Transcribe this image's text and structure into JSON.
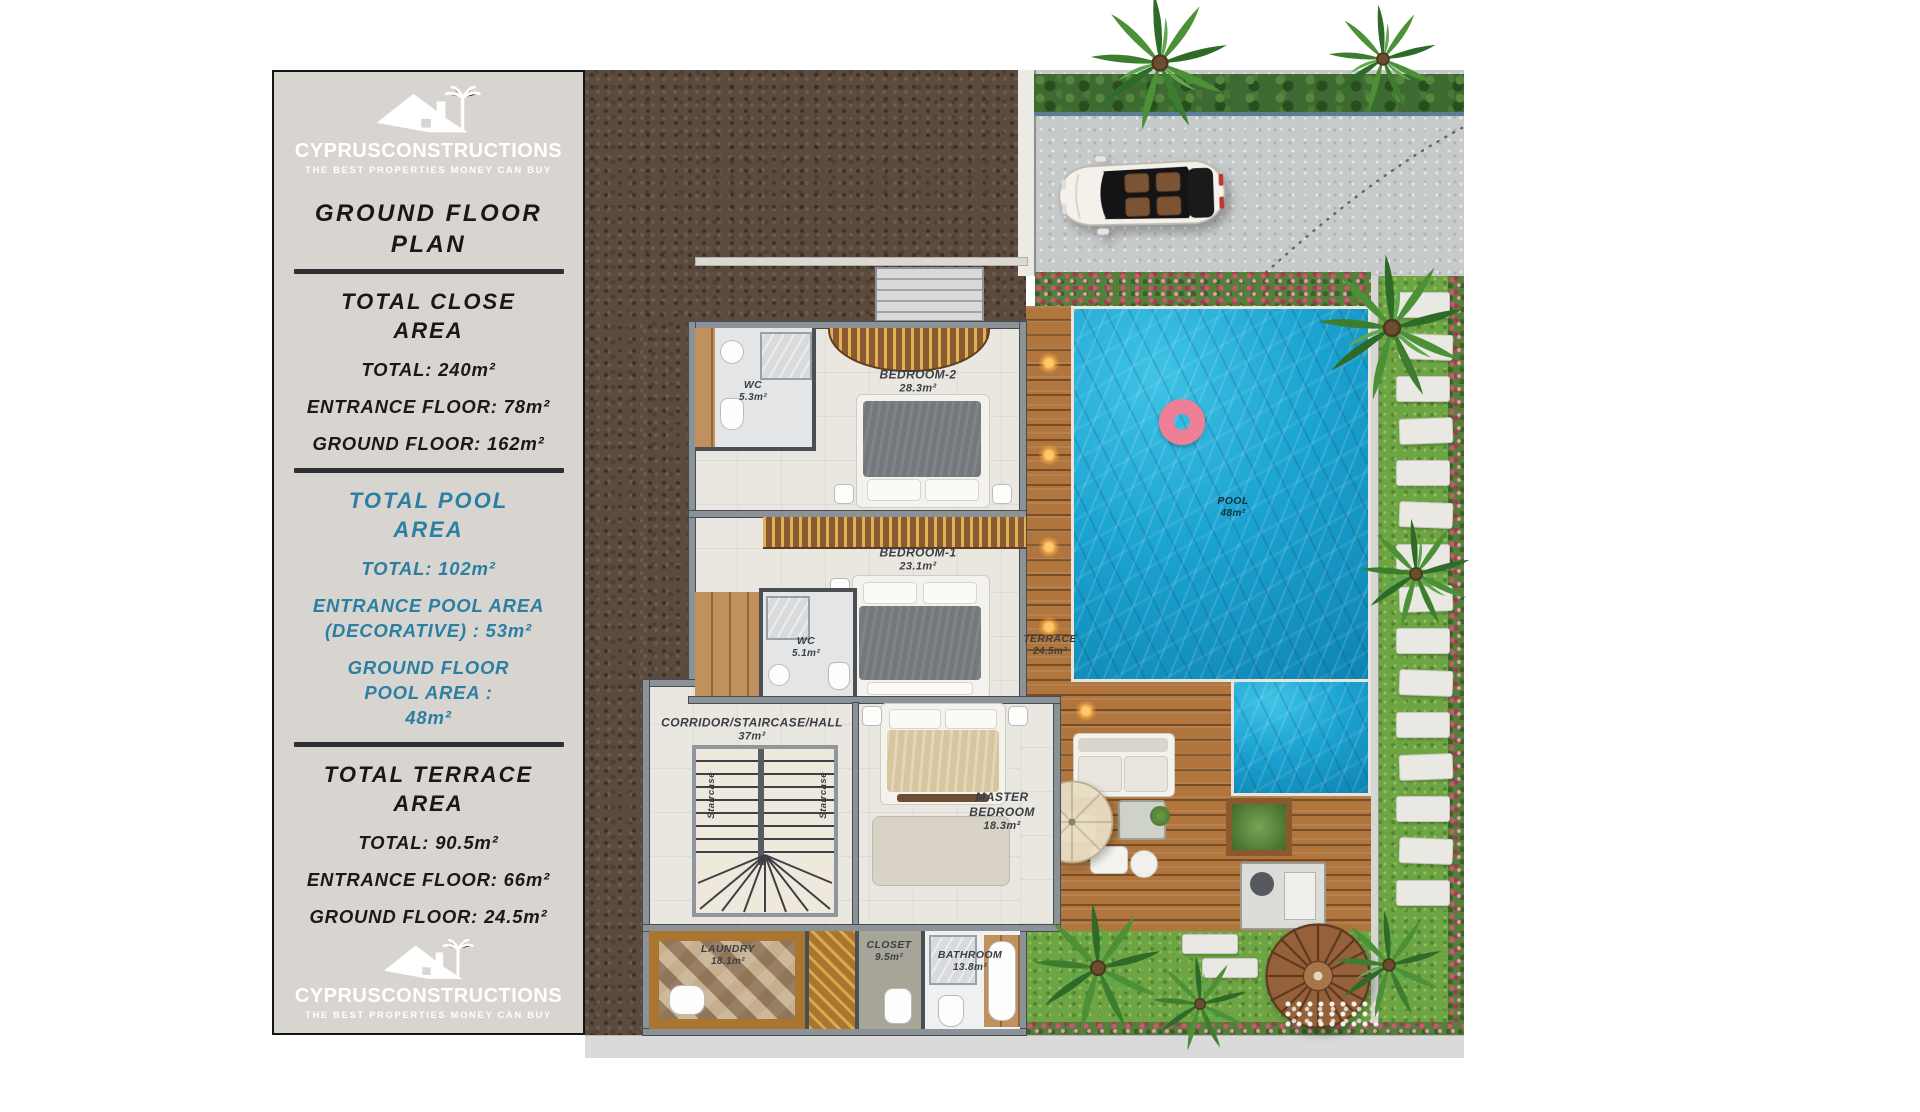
{
  "panel": {
    "brand": "CYPRUSCONSTRUCTIONS",
    "tagline": "THE BEST PROPERTIES MONEY CAN BUY",
    "title": "GROUND FLOOR PLAN",
    "close_area": {
      "heading": "TOTAL CLOSE AREA",
      "total": "TOTAL: 240m²",
      "entrance": "ENTRANCE FLOOR: 78m²",
      "ground": "GROUND FLOOR: 162m²"
    },
    "pool_area": {
      "heading": "TOTAL POOL AREA",
      "total": "TOTAL: 102m²",
      "entrance": "ENTRANCE POOL AREA (DECORATIVE) : 53m²",
      "ground": "GROUND FLOOR POOL AREA : 48m²"
    },
    "terrace_area": {
      "heading": "TOTAL TERRACE AREA",
      "total": "TOTAL: 90.5m²",
      "entrance": "ENTRANCE FLOOR: 66m²",
      "ground": "GROUND FLOOR: 24.5m²"
    }
  },
  "plan": {
    "rooms": [
      {
        "name": "WC",
        "area": "5.3m²"
      },
      {
        "name": "BEDROOM-2",
        "area": "28.3m²"
      },
      {
        "name": "BEDROOM-1",
        "area": "23.1m²"
      },
      {
        "name": "WC",
        "area": "5.1m²"
      },
      {
        "name": "CORRIDOR/STAIRCASE/HALL",
        "area": "37m²"
      },
      {
        "name": "MASTER BEDROOM",
        "area": "18.3m²"
      },
      {
        "name": "TERRACE",
        "area": "24.5m²"
      },
      {
        "name": "POOL",
        "area": "48m²"
      },
      {
        "name": "LAUNDRY",
        "area": "18.1m²"
      },
      {
        "name": "CLOSET",
        "area": "9.5m²"
      },
      {
        "name": "BATHROOM",
        "area": "13.8m²"
      }
    ],
    "staircase_label": "Staircase"
  },
  "colors": {
    "panel_bg": "#d8d5d1",
    "accent_teal": "#2b7fa3",
    "text_dark": "#181818",
    "pool_blue": "#1ba3d1",
    "deck_wood": "#b0763e",
    "grass_green": "#6ea544",
    "soil_brown": "#5b4b3e",
    "swim_ring_pink": "#ee7f97"
  }
}
